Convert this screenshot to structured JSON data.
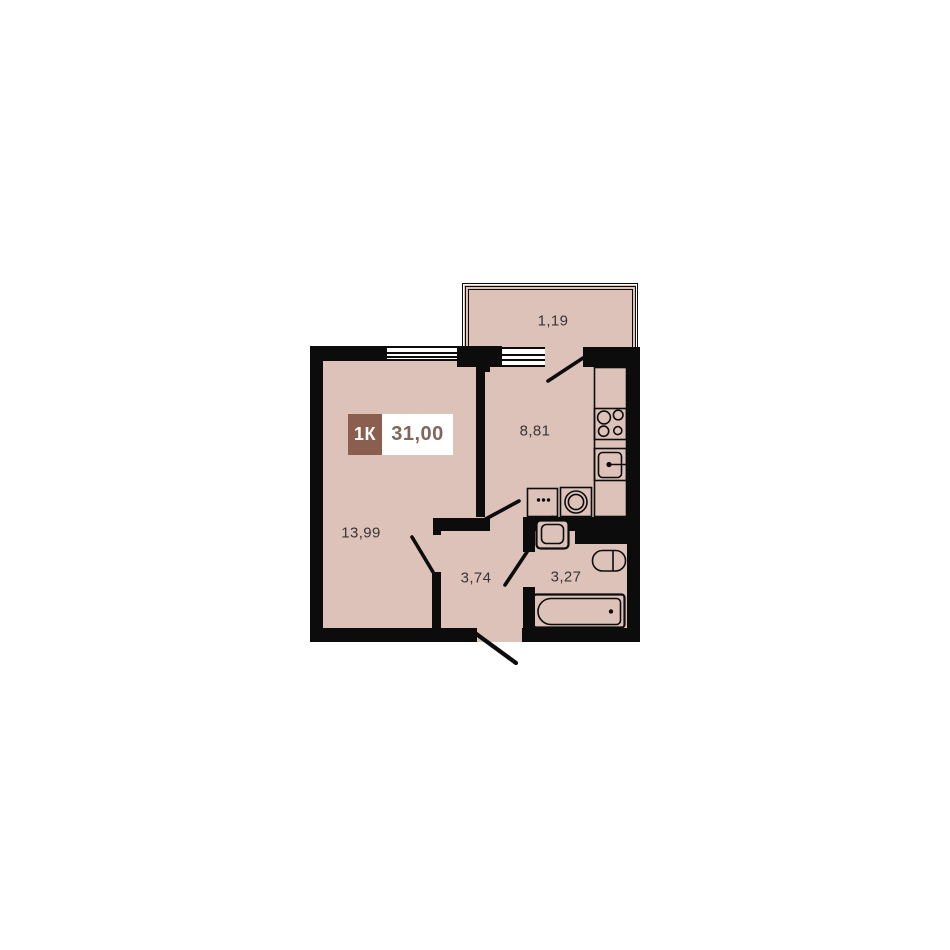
{
  "colors": {
    "floor": "#ddc2ba",
    "wall": "#0c0c0c",
    "white": "#ffffff",
    "badge_brown": "#8a5f4e",
    "badge_area_text": "#82665a",
    "label_text": "#3a3335"
  },
  "badge": {
    "type": "1К",
    "area": "31,00"
  },
  "rooms": {
    "balcony": {
      "area": "1,19"
    },
    "kitchen": {
      "area": "8,81"
    },
    "living": {
      "area": "13,99"
    },
    "hallway": {
      "area": "3,74"
    },
    "bathroom": {
      "area": "3,27"
    }
  }
}
